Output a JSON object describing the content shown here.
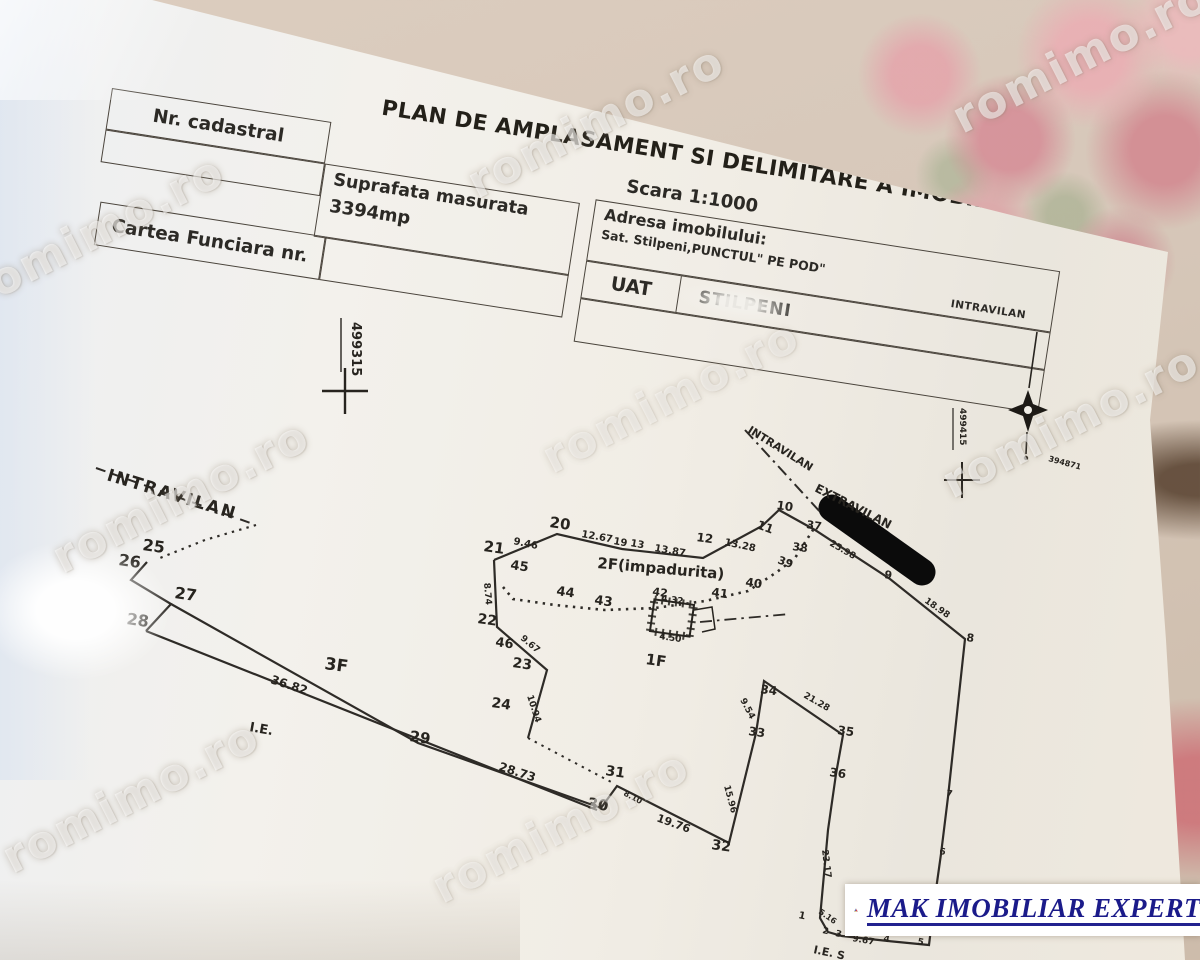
{
  "document": {
    "title": "PLAN DE AMPLASAMENT SI DELIMITARE A IMOBILULUI",
    "scale": "Scara 1:1000",
    "fields": {
      "nr_cadastral_label": "Nr. cadastral",
      "suprafata_label": "Suprafata masurata",
      "suprafata_value": "3394mp",
      "carte_funciara_label": "Cartea Funciara nr.",
      "adresa_label": "Adresa imobilului:",
      "adresa_value": "Sat. Stilpeni,PUNCTUL\" PE POD\"",
      "adresa_zone": "INTRAVILAN",
      "uat_label": "UAT",
      "uat_value": "STILPENI"
    }
  },
  "watermark": {
    "text": "romimo.ro"
  },
  "logo": {
    "text": "MAK IMOBILIAR EXPERT"
  },
  "plan": {
    "paths": [
      {
        "d": "solid",
        "w": 2.2,
        "pts": [
          [
            494,
            560
          ],
          [
            557,
            534
          ],
          [
            622,
            549
          ],
          [
            703,
            558
          ],
          [
            762,
            526
          ],
          [
            779,
            510
          ],
          [
            815,
            530
          ],
          [
            890,
            579
          ],
          [
            965,
            639
          ],
          [
            948,
            797
          ],
          [
            941,
            854
          ],
          [
            934,
            904
          ],
          [
            929,
            945
          ],
          [
            888,
            941
          ],
          [
            842,
            936
          ],
          [
            828,
            932
          ],
          [
            820,
            918
          ],
          [
            828,
            830
          ],
          [
            836,
            774
          ],
          [
            843,
            735
          ],
          [
            764,
            681
          ],
          [
            756,
            733
          ],
          [
            729,
            843
          ],
          [
            617,
            786
          ],
          [
            601,
            808
          ],
          [
            418,
            743
          ],
          [
            171,
            604
          ]
        ]
      },
      {
        "d": "solid",
        "w": 2.2,
        "pts": [
          [
            147,
            562
          ],
          [
            131,
            580
          ],
          [
            171,
            604
          ],
          [
            146,
            631
          ]
        ]
      },
      {
        "d": "solid",
        "w": 2.2,
        "pts": [
          [
            146,
            631
          ],
          [
            597,
            810
          ]
        ]
      },
      {
        "d": "solid",
        "w": 2.2,
        "pts": [
          [
            494,
            560
          ],
          [
            497,
            627
          ],
          [
            547,
            670
          ],
          [
            528,
            738
          ]
        ]
      },
      {
        "d": "dashed",
        "w": 2,
        "pts": [
          [
            96,
            468
          ],
          [
            256,
            525
          ]
        ]
      },
      {
        "d": "dotted",
        "w": 2.2,
        "pts": [
          [
            256,
            525
          ],
          [
            205,
            540
          ],
          [
            160,
            558
          ]
        ]
      },
      {
        "d": "dotted",
        "w": 2.6,
        "pts": [
          [
            503,
            587
          ],
          [
            513,
            599
          ],
          [
            555,
            605
          ],
          [
            605,
            610
          ],
          [
            655,
            608
          ],
          [
            705,
            601
          ],
          [
            748,
            591
          ],
          [
            777,
            572
          ],
          [
            795,
            558
          ],
          [
            813,
            530
          ]
        ]
      },
      {
        "d": "dotted",
        "w": 2,
        "pts": [
          [
            528,
            738
          ],
          [
            613,
            783
          ]
        ]
      },
      {
        "d": "dashdot",
        "w": 2,
        "pts": [
          [
            745,
            430
          ],
          [
            822,
            514
          ]
        ]
      },
      {
        "d": "dashdot",
        "w": 1.8,
        "pts": [
          [
            700,
            622
          ],
          [
            790,
            614
          ]
        ]
      }
    ],
    "labels": [
      {
        "t": "21",
        "x": 483,
        "y": 551,
        "r": 8,
        "s": 15
      },
      {
        "t": "20",
        "x": 549,
        "y": 527,
        "r": 8,
        "s": 15
      },
      {
        "t": "9.46",
        "x": 513,
        "y": 544,
        "r": 12,
        "s": 10
      },
      {
        "t": "12.67",
        "x": 581,
        "y": 537,
        "r": 10,
        "s": 10
      },
      {
        "t": "19",
        "x": 613,
        "y": 544,
        "r": 10,
        "s": 10
      },
      {
        "t": "13",
        "x": 630,
        "y": 546,
        "r": 10,
        "s": 10
      },
      {
        "t": "13.87",
        "x": 654,
        "y": 551,
        "r": 10,
        "s": 10
      },
      {
        "t": "12",
        "x": 696,
        "y": 541,
        "r": 8,
        "s": 12
      },
      {
        "t": "13.28",
        "x": 724,
        "y": 545,
        "r": 12,
        "s": 10
      },
      {
        "t": "11",
        "x": 756,
        "y": 528,
        "r": 20,
        "s": 12
      },
      {
        "t": "10",
        "x": 776,
        "y": 509,
        "r": 8,
        "s": 12
      },
      {
        "t": "37",
        "x": 806,
        "y": 528,
        "r": 8,
        "s": 11
      },
      {
        "t": "38",
        "x": 792,
        "y": 550,
        "r": 8,
        "s": 11
      },
      {
        "t": "39",
        "x": 777,
        "y": 563,
        "r": 20,
        "s": 11
      },
      {
        "t": "40",
        "x": 745,
        "y": 586,
        "r": 8,
        "s": 12
      },
      {
        "t": "41",
        "x": 711,
        "y": 596,
        "r": 8,
        "s": 12
      },
      {
        "t": "42",
        "x": 652,
        "y": 595,
        "r": 8,
        "s": 11
      },
      {
        "t": "43",
        "x": 594,
        "y": 604,
        "r": 8,
        "s": 13
      },
      {
        "t": "44",
        "x": 556,
        "y": 595,
        "r": 8,
        "s": 13
      },
      {
        "t": "45",
        "x": 510,
        "y": 569,
        "r": 8,
        "s": 13
      },
      {
        "t": "46",
        "x": 495,
        "y": 646,
        "r": 8,
        "s": 13
      },
      {
        "t": "22",
        "x": 477,
        "y": 623,
        "r": 8,
        "s": 14
      },
      {
        "t": "23",
        "x": 512,
        "y": 667,
        "r": 8,
        "s": 14
      },
      {
        "t": "24",
        "x": 491,
        "y": 707,
        "r": 8,
        "s": 14
      },
      {
        "t": "25",
        "x": 142,
        "y": 550,
        "r": 8,
        "s": 16
      },
      {
        "t": "26",
        "x": 118,
        "y": 565,
        "r": 8,
        "s": 16
      },
      {
        "t": "27",
        "x": 174,
        "y": 598,
        "r": 8,
        "s": 16
      },
      {
        "t": "28",
        "x": 126,
        "y": 624,
        "r": 8,
        "s": 16
      },
      {
        "t": "29",
        "x": 409,
        "y": 741,
        "r": 8,
        "s": 15
      },
      {
        "t": "30",
        "x": 587,
        "y": 808,
        "r": 8,
        "s": 15
      },
      {
        "t": "31",
        "x": 605,
        "y": 775,
        "r": 8,
        "s": 14
      },
      {
        "t": "32",
        "x": 711,
        "y": 849,
        "r": 8,
        "s": 14
      },
      {
        "t": "33",
        "x": 748,
        "y": 735,
        "r": 8,
        "s": 12
      },
      {
        "t": "34",
        "x": 760,
        "y": 693,
        "r": 8,
        "s": 12
      },
      {
        "t": "35",
        "x": 837,
        "y": 734,
        "r": 8,
        "s": 12
      },
      {
        "t": "36",
        "x": 829,
        "y": 776,
        "r": 8,
        "s": 12
      },
      {
        "t": "9",
        "x": 884,
        "y": 578,
        "r": 8,
        "s": 11
      },
      {
        "t": "8",
        "x": 966,
        "y": 641,
        "r": 8,
        "s": 11
      },
      {
        "t": "7",
        "x": 946,
        "y": 796,
        "r": 8,
        "s": 9
      },
      {
        "t": "6",
        "x": 939,
        "y": 854,
        "r": 8,
        "s": 9
      },
      {
        "t": "1",
        "x": 798,
        "y": 918,
        "r": 12,
        "s": 10
      },
      {
        "t": "2",
        "x": 822,
        "y": 933,
        "r": 12,
        "s": 9
      },
      {
        "t": "3",
        "x": 835,
        "y": 936,
        "r": 12,
        "s": 9
      },
      {
        "t": "4",
        "x": 883,
        "y": 941,
        "r": 12,
        "s": 9
      },
      {
        "t": "5",
        "x": 917,
        "y": 944,
        "r": 12,
        "s": 9
      },
      {
        "t": "8.74",
        "x": 484,
        "y": 583,
        "r": 85,
        "s": 9
      },
      {
        "t": "9.67",
        "x": 520,
        "y": 639,
        "r": 40,
        "s": 9
      },
      {
        "t": "10.94",
        "x": 527,
        "y": 696,
        "r": 72,
        "s": 9
      },
      {
        "t": "25.98",
        "x": 829,
        "y": 545,
        "r": 30,
        "s": 9
      },
      {
        "t": "18.98",
        "x": 924,
        "y": 602,
        "r": 35,
        "s": 9
      },
      {
        "t": "36.82",
        "x": 270,
        "y": 683,
        "r": 18,
        "s": 12
      },
      {
        "t": "28.73",
        "x": 498,
        "y": 770,
        "r": 18,
        "s": 12
      },
      {
        "t": "8.10",
        "x": 623,
        "y": 795,
        "r": 28,
        "s": 8
      },
      {
        "t": "19.76",
        "x": 656,
        "y": 821,
        "r": 20,
        "s": 11
      },
      {
        "t": "15.96",
        "x": 724,
        "y": 786,
        "r": 75,
        "s": 9
      },
      {
        "t": "9.54",
        "x": 740,
        "y": 700,
        "r": 62,
        "s": 9
      },
      {
        "t": "21.28",
        "x": 803,
        "y": 697,
        "r": 30,
        "s": 9
      },
      {
        "t": "23.17",
        "x": 822,
        "y": 850,
        "r": 83,
        "s": 9
      },
      {
        "t": "9.67",
        "x": 852,
        "y": 941,
        "r": 10,
        "s": 9
      },
      {
        "t": "4.67",
        "x": 898,
        "y": 929,
        "r": 10,
        "s": 9
      },
      {
        "t": "5.16",
        "x": 818,
        "y": 913,
        "r": 35,
        "s": 8
      },
      {
        "t": "4.32",
        "x": 661,
        "y": 601,
        "r": 8,
        "s": 9
      },
      {
        "t": "4.50",
        "x": 659,
        "y": 639,
        "r": 8,
        "s": 9
      },
      {
        "t": "INTRAVILAN",
        "x": 106,
        "y": 480,
        "r": 17,
        "s": 17,
        "ls": 2
      },
      {
        "t": "INTRAVILAN",
        "x": 747,
        "y": 432,
        "r": 32,
        "s": 11
      },
      {
        "t": "EXTRAVILAN",
        "x": 814,
        "y": 491,
        "r": 27,
        "s": 12
      },
      {
        "t": "2F(impadurita)",
        "x": 597,
        "y": 568,
        "r": 5,
        "s": 15
      },
      {
        "t": "1F",
        "x": 645,
        "y": 664,
        "r": 8,
        "s": 15
      },
      {
        "t": "3F",
        "x": 324,
        "y": 669,
        "r": 8,
        "s": 17
      },
      {
        "t": "I.E.",
        "x": 249,
        "y": 731,
        "r": 10,
        "s": 13
      },
      {
        "t": "I.E. S",
        "x": 813,
        "y": 953,
        "r": 12,
        "s": 11
      },
      {
        "t": "499315",
        "x": 352,
        "y": 322,
        "r": 90,
        "s": 13
      },
      {
        "t": "499415",
        "x": 960,
        "y": 408,
        "r": 90,
        "s": 9
      },
      {
        "t": "394871",
        "x": 1048,
        "y": 461,
        "r": 15,
        "s": 8
      }
    ]
  }
}
